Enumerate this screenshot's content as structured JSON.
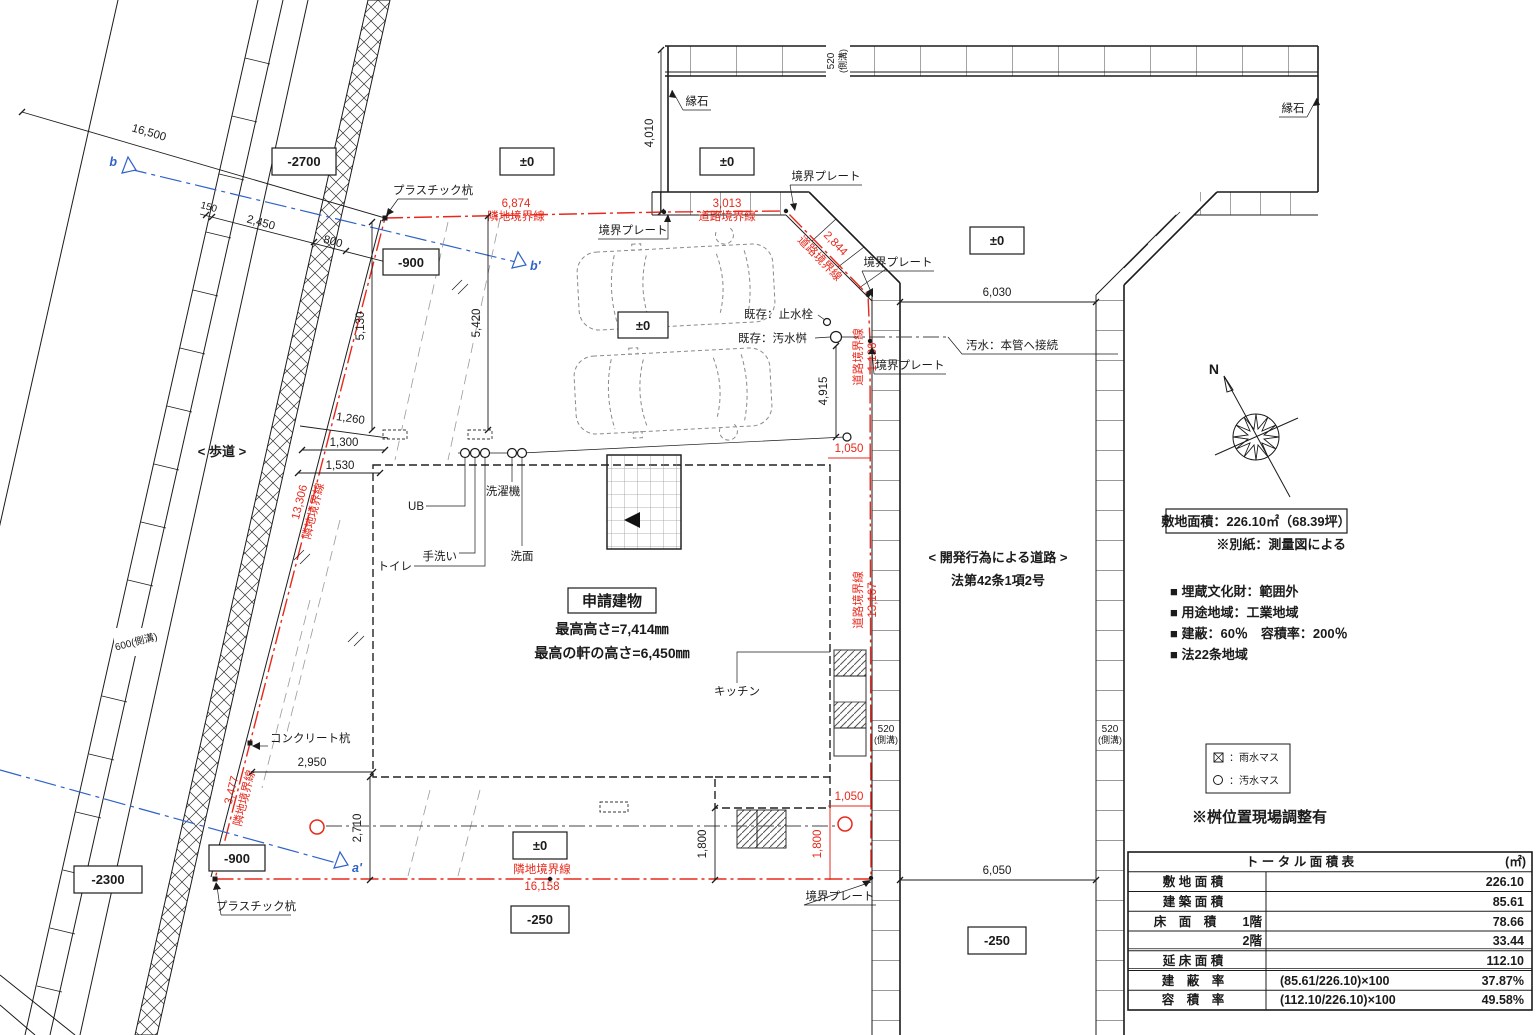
{
  "colors": {
    "line": "#1b1b1b",
    "red": "#e8281c",
    "blue": "#2f62c9",
    "gray": "#9a9a9a"
  },
  "levels": [
    "-2700",
    "±0",
    "±0",
    "±0",
    "-900",
    "±0",
    "-900",
    "-2300",
    "±0",
    "-250",
    "-250"
  ],
  "dims": {
    "d16500": "16,500",
    "d150": "150",
    "d2450": "2,450",
    "d800": "800",
    "d4010": "4,010",
    "d6030": "6,030",
    "d4915": "4,915",
    "d5130": "5,130",
    "d5420": "5,420",
    "d1260": "1,260",
    "d1300": "1,300",
    "d1530": "1,530",
    "d2950": "2,950",
    "d2710": "2,710",
    "d1800": "1,800",
    "d6050": "6,050"
  },
  "boundary": {
    "adjacent": "隣地境界線",
    "road": "道路境界線",
    "d6874": "6,874",
    "d3013": "3,013",
    "d2844": "2,844",
    "d1136": "1,136",
    "d13167": "13,167",
    "d13306": "13,306",
    "d3477": "3,477",
    "d16158": "16,158",
    "d1050": "1,050",
    "d1800": "1,800"
  },
  "gutters": {
    "w520": "520",
    "w600": "600",
    "side": "(側溝)"
  },
  "labels": {
    "hodou": "< 歩道 >",
    "kaihatsu": "< 開発行為による道路 >",
    "houjo": "法第42条1項2号",
    "enseki": "縁石",
    "kyokai_plate": "境界プレート",
    "plastic_kui": "プラスチック杭",
    "concrete_kui": "コンクリート杭",
    "kizon_shisui": "既存：止水栓",
    "kizon_osui": "既存：汚水桝",
    "osui_honkan": "汚水：本管へ接続",
    "ub": "UB",
    "sentakuki": "洗濯機",
    "tearai": "手洗い",
    "toire": "トイレ",
    "senmen": "洗面",
    "kitchen": "キッチン"
  },
  "building": {
    "name": "申請建物",
    "height1": "最高高さ=7,414㎜",
    "height2": "最高の軒の高さ=6,450㎜"
  },
  "site": {
    "area_box": "敷地面積：226.10㎡（68.39坪）",
    "note_ref": "※別紙：測量図による",
    "notes": [
      "■ 埋蔵文化財：範囲外",
      "■ 用途地域：工業地域",
      "■ 建蔽：60％　容積率：200％",
      "■ 法22条地域"
    ],
    "masu_note": "※桝位置現場調整有"
  },
  "legend": {
    "rain": "：雨水マス",
    "sewage": "：汚水マス"
  },
  "sections": {
    "b": "b",
    "b_end": "b'",
    "a_end": "a'"
  },
  "compass": {
    "north": "N"
  },
  "table": {
    "title": "ト ー タ ル 面 積 表",
    "unit": "(㎡)",
    "rows": [
      {
        "label": "敷 地 面 積",
        "sub": "",
        "calc": "",
        "value": "226.10"
      },
      {
        "label": "建 築 面 積",
        "sub": "",
        "calc": "",
        "value": "85.61"
      },
      {
        "label": "床　面　積",
        "sub": "1階",
        "calc": "",
        "value": "78.66"
      },
      {
        "label": "",
        "sub": "2階",
        "calc": "",
        "value": "33.44"
      },
      {
        "label": "延 床 面 積",
        "sub": "",
        "calc": "",
        "value": "112.10"
      },
      {
        "label": "建　蔽　率",
        "sub": "",
        "calc": "(85.61/226.10)×100",
        "value": "37.87%"
      },
      {
        "label": "容　積　率",
        "sub": "",
        "calc": "(112.10/226.10)×100",
        "value": "49.58%"
      }
    ]
  }
}
